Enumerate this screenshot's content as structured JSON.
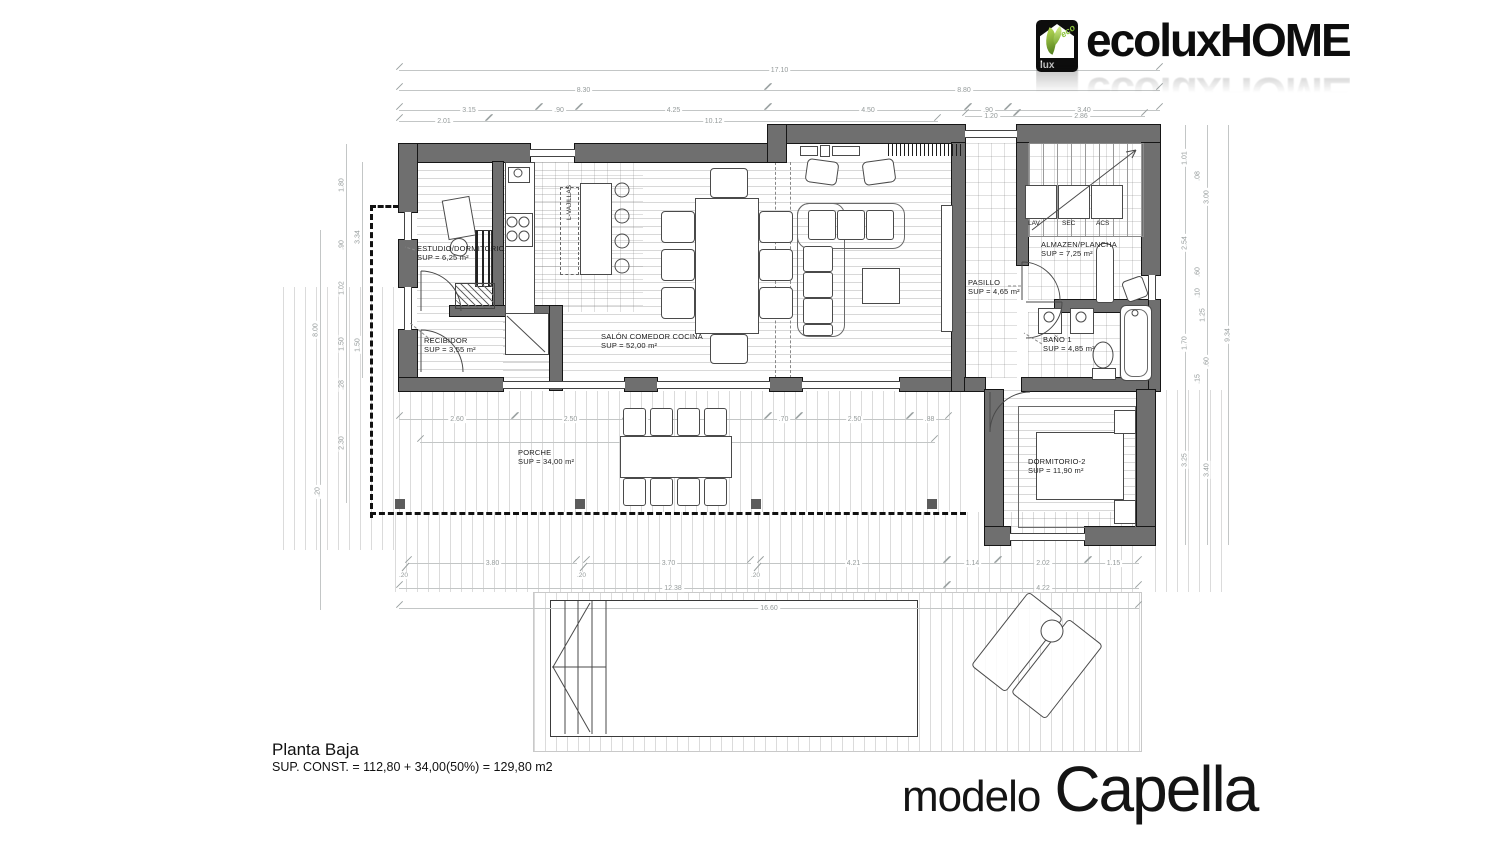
{
  "meta": {
    "plan_title": "Planta Baja",
    "area_text": "SUP. CONST. = 112,80 + 34,00(50%) = 129,80 m2",
    "model_label": "modelo",
    "model_name": "Capella"
  },
  "logo": {
    "word_main": "ecolux",
    "word_secondary": "HOME",
    "icon_eco": "eco",
    "icon_lux": "lux",
    "accent_green": "#8dc63f"
  },
  "rooms": {
    "estudio": {
      "name": "ESTUDIO/DORMITORIO",
      "sup": "SUP = 6,25 m²"
    },
    "recibidor": {
      "name": "RECIBIDOR",
      "sup": "SUP = 3,55 m²"
    },
    "salon": {
      "name": "SALÓN COMEDOR COCINA",
      "sup": "SUP = 52,00 m²"
    },
    "porche": {
      "name": "PORCHE",
      "sup": "SUP = 34,00 m²"
    },
    "pasillo": {
      "name": "PASILLO",
      "sup": "SUP = 4,65 m²"
    },
    "almacen": {
      "name": "ALMAZEN/PLANCHA",
      "sup": "SUP = 7,25 m²"
    },
    "bano": {
      "name": "BAÑO 1",
      "sup": "SUP = 4,85 m²"
    },
    "dormitorio2": {
      "name": "DORMITORIO-2",
      "sup": "SUP = 11,90 m²"
    }
  },
  "labels": {
    "vajillas": "L-VAJILLAS",
    "lav": "LAV",
    "sec": "SEC",
    "acs": "ACS"
  },
  "dims": {
    "t1": [
      "17.10"
    ],
    "t2": [
      "8.30",
      "8.80"
    ],
    "t3": [
      "3.15",
      ".90",
      "4.25",
      "4.50",
      ".90",
      "3.40"
    ],
    "t4": [
      "2.01",
      "10.12",
      "1.20",
      "2.86"
    ],
    "left": [
      "8.00",
      "1.80",
      ".90",
      "1.02",
      "1.50",
      ".28",
      "2.30",
      ".20",
      "3.34",
      "1.50"
    ],
    "right": [
      "1.01",
      ".08",
      "2.54",
      ".60",
      ".10",
      "1.25",
      "1.70",
      ".60",
      ".15",
      "3.25",
      "3.00",
      "3.40",
      "9.34"
    ],
    "mid": [
      "2.60",
      "2.50",
      ".70",
      "2.50",
      ".70",
      "2.50",
      ".88"
    ],
    "mid_total": "12.38",
    "b1": [
      "3.80",
      "3.70",
      "4.21",
      "1.14",
      "2.02",
      "1.15"
    ],
    "b1_small": [
      ".20",
      ".20",
      ".20"
    ],
    "b2": [
      "12.38",
      "4.22"
    ],
    "b3": "16.60"
  },
  "colors": {
    "wall": "#6f6f6f",
    "dim_text": "#959b9b",
    "ink": "#111111"
  }
}
